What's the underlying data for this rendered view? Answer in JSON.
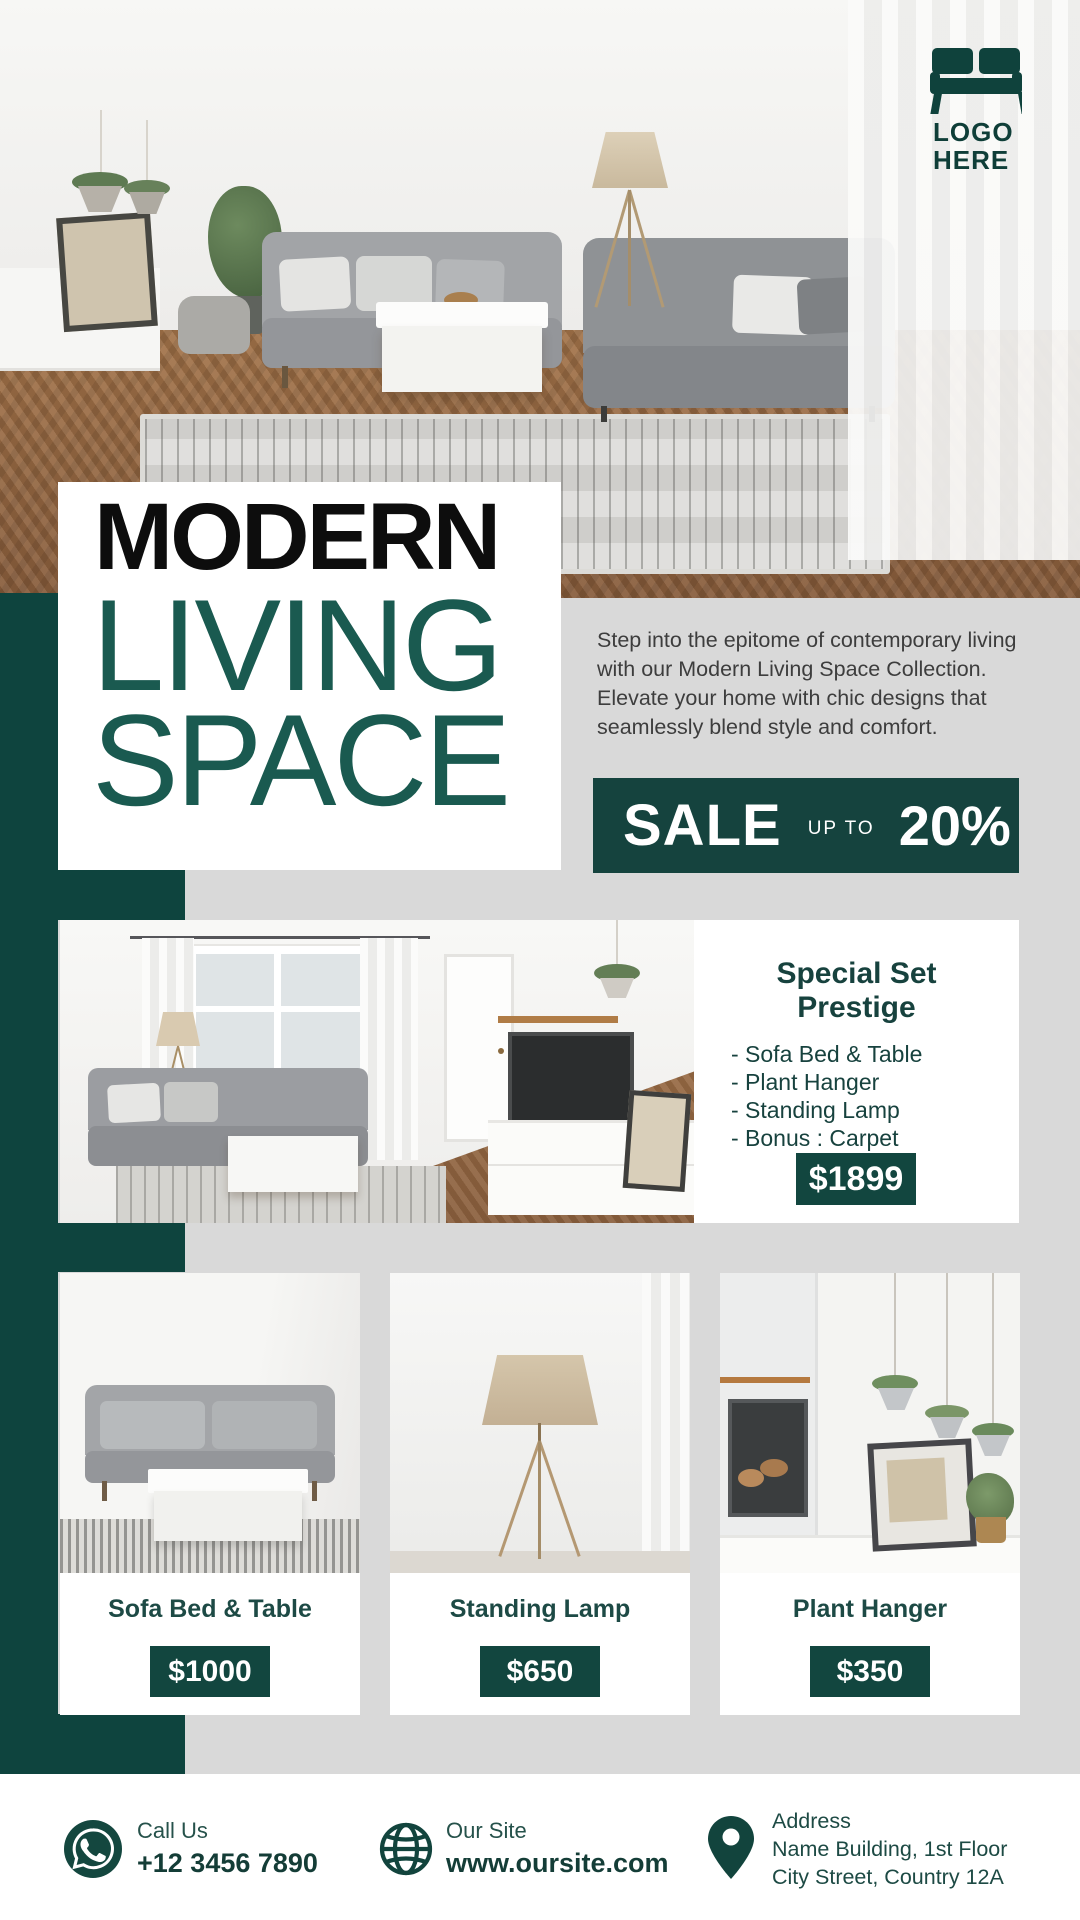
{
  "logo": {
    "line1": "LOGO",
    "line2": "HERE",
    "icon": "sofa-icon"
  },
  "title": {
    "line1": "MODERN",
    "line2": "LIVING",
    "line3": "SPACE"
  },
  "intro": "Step into the epitome of contemporary living with our Modern Living Space Collection. Elevate your home with chic designs that seamlessly blend style and comfort.",
  "sale": {
    "word": "SALE",
    "upto": "UP TO",
    "percent": "20%"
  },
  "special": {
    "title_line1": "Special Set",
    "title_line2": "Prestige",
    "items": [
      "- Sofa Bed & Table",
      "- Plant Hanger",
      "- Standing Lamp",
      "- Bonus : Carpet"
    ],
    "price": "$1899"
  },
  "products": [
    {
      "name": "Sofa Bed & Table",
      "price": "$1000"
    },
    {
      "name": "Standing Lamp",
      "price": "$650"
    },
    {
      "name": "Plant Hanger",
      "price": "$350"
    }
  ],
  "footer": {
    "call": {
      "label": "Call Us",
      "value": "+12 3456 7890",
      "icon": "whatsapp-icon"
    },
    "site": {
      "label": "Our Site",
      "value": "www.oursite.com",
      "icon": "globe-icon"
    },
    "address": {
      "label": "Address",
      "line1": "Name Building, 1st Floor",
      "line2": "City Street, Country 12A",
      "icon": "location-pin-icon"
    }
  },
  "colors": {
    "teal_solid": "#0e443e",
    "teal_banner": "#15433e",
    "teal_button": "#12463f",
    "teal_title_text": "#1a5a50",
    "teal_dark_text": "#17423e",
    "background": "#d9d9d9",
    "title_black": "#0d0d0d",
    "white": "#ffffff"
  }
}
